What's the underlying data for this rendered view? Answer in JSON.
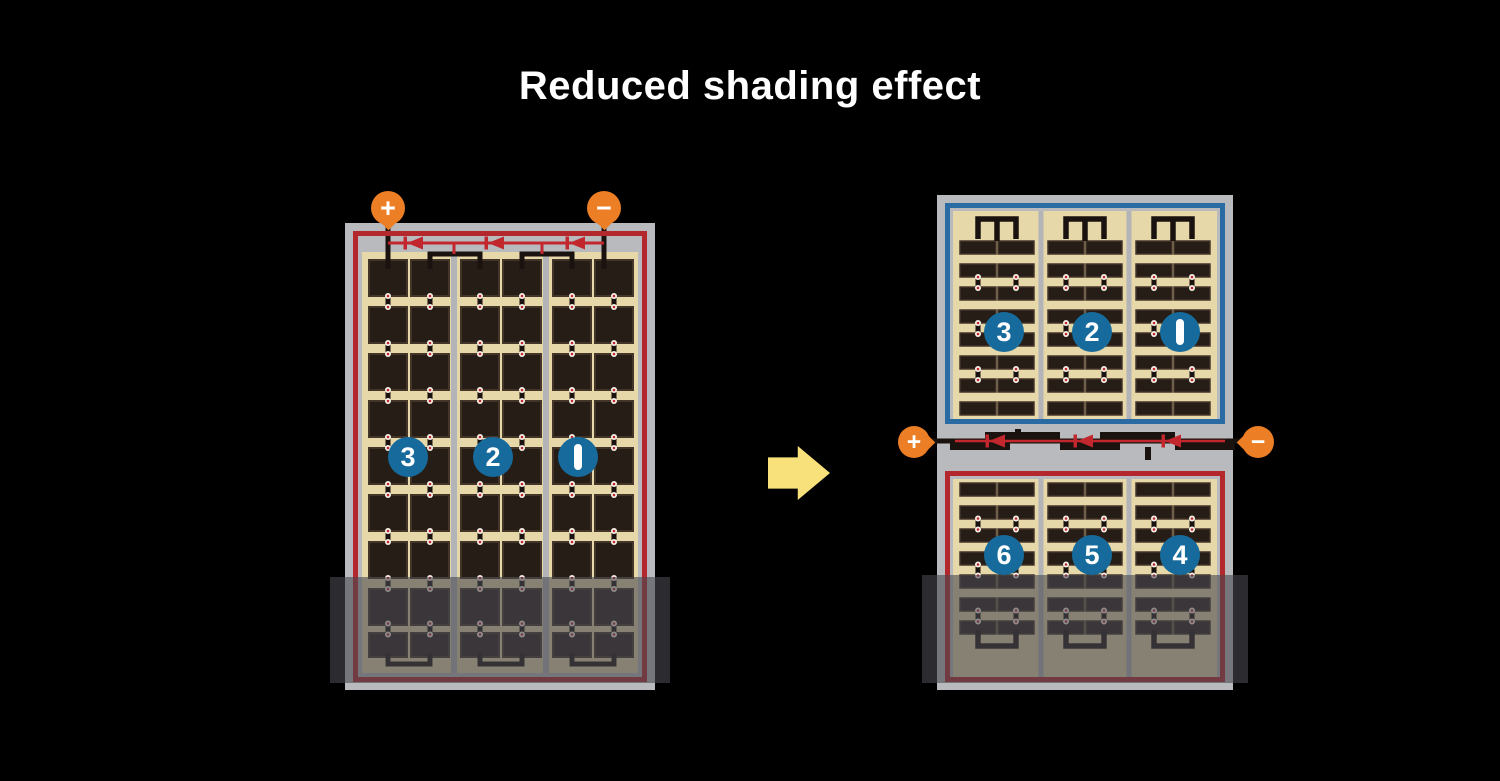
{
  "title": "Reduced shading effect",
  "colors": {
    "background": "#000000",
    "title_text": "#ffffff",
    "frame_gray": "#b9babd",
    "divider_gray": "#b2b4b7",
    "cell_tan": "#e7d8aa",
    "cell_dark": "#261d17",
    "cell_outline": "#433528",
    "wire_black": "#1a120e",
    "red_border": "#b2282c",
    "diode_red": "#c1272d",
    "blue_border": "#2b6ba3",
    "badge_blue": "#176b9c",
    "terminal_orange": "#ec7e26",
    "arrow_yellow": "#f8e17b",
    "shade": "rgba(72,72,80,0.6)"
  },
  "before": {
    "plus": "+",
    "minus": "−",
    "strings": [
      {
        "number": "3"
      },
      {
        "number": "2"
      },
      {
        "number": "1"
      }
    ],
    "grid": {
      "sections": 3,
      "columns_per_section": 2,
      "rows": 9,
      "cell_shape": "square",
      "bypass_diodes": 3
    }
  },
  "after": {
    "top": {
      "strings": [
        {
          "number": "3"
        },
        {
          "number": "2"
        },
        {
          "number": "1"
        }
      ],
      "grid": {
        "sections": 3,
        "columns_per_section": 2,
        "rows": 8,
        "cell_shape": "half-cut bar"
      }
    },
    "bottom": {
      "strings": [
        {
          "number": "6"
        },
        {
          "number": "5"
        },
        {
          "number": "4"
        }
      ],
      "grid": {
        "sections": 3,
        "columns_per_section": 2,
        "rows": 7,
        "cell_shape": "half-cut bar"
      }
    },
    "junction": {
      "plus": "+",
      "minus": "−",
      "bypass_diodes": 3
    }
  },
  "arrow": {
    "direction": "right"
  }
}
